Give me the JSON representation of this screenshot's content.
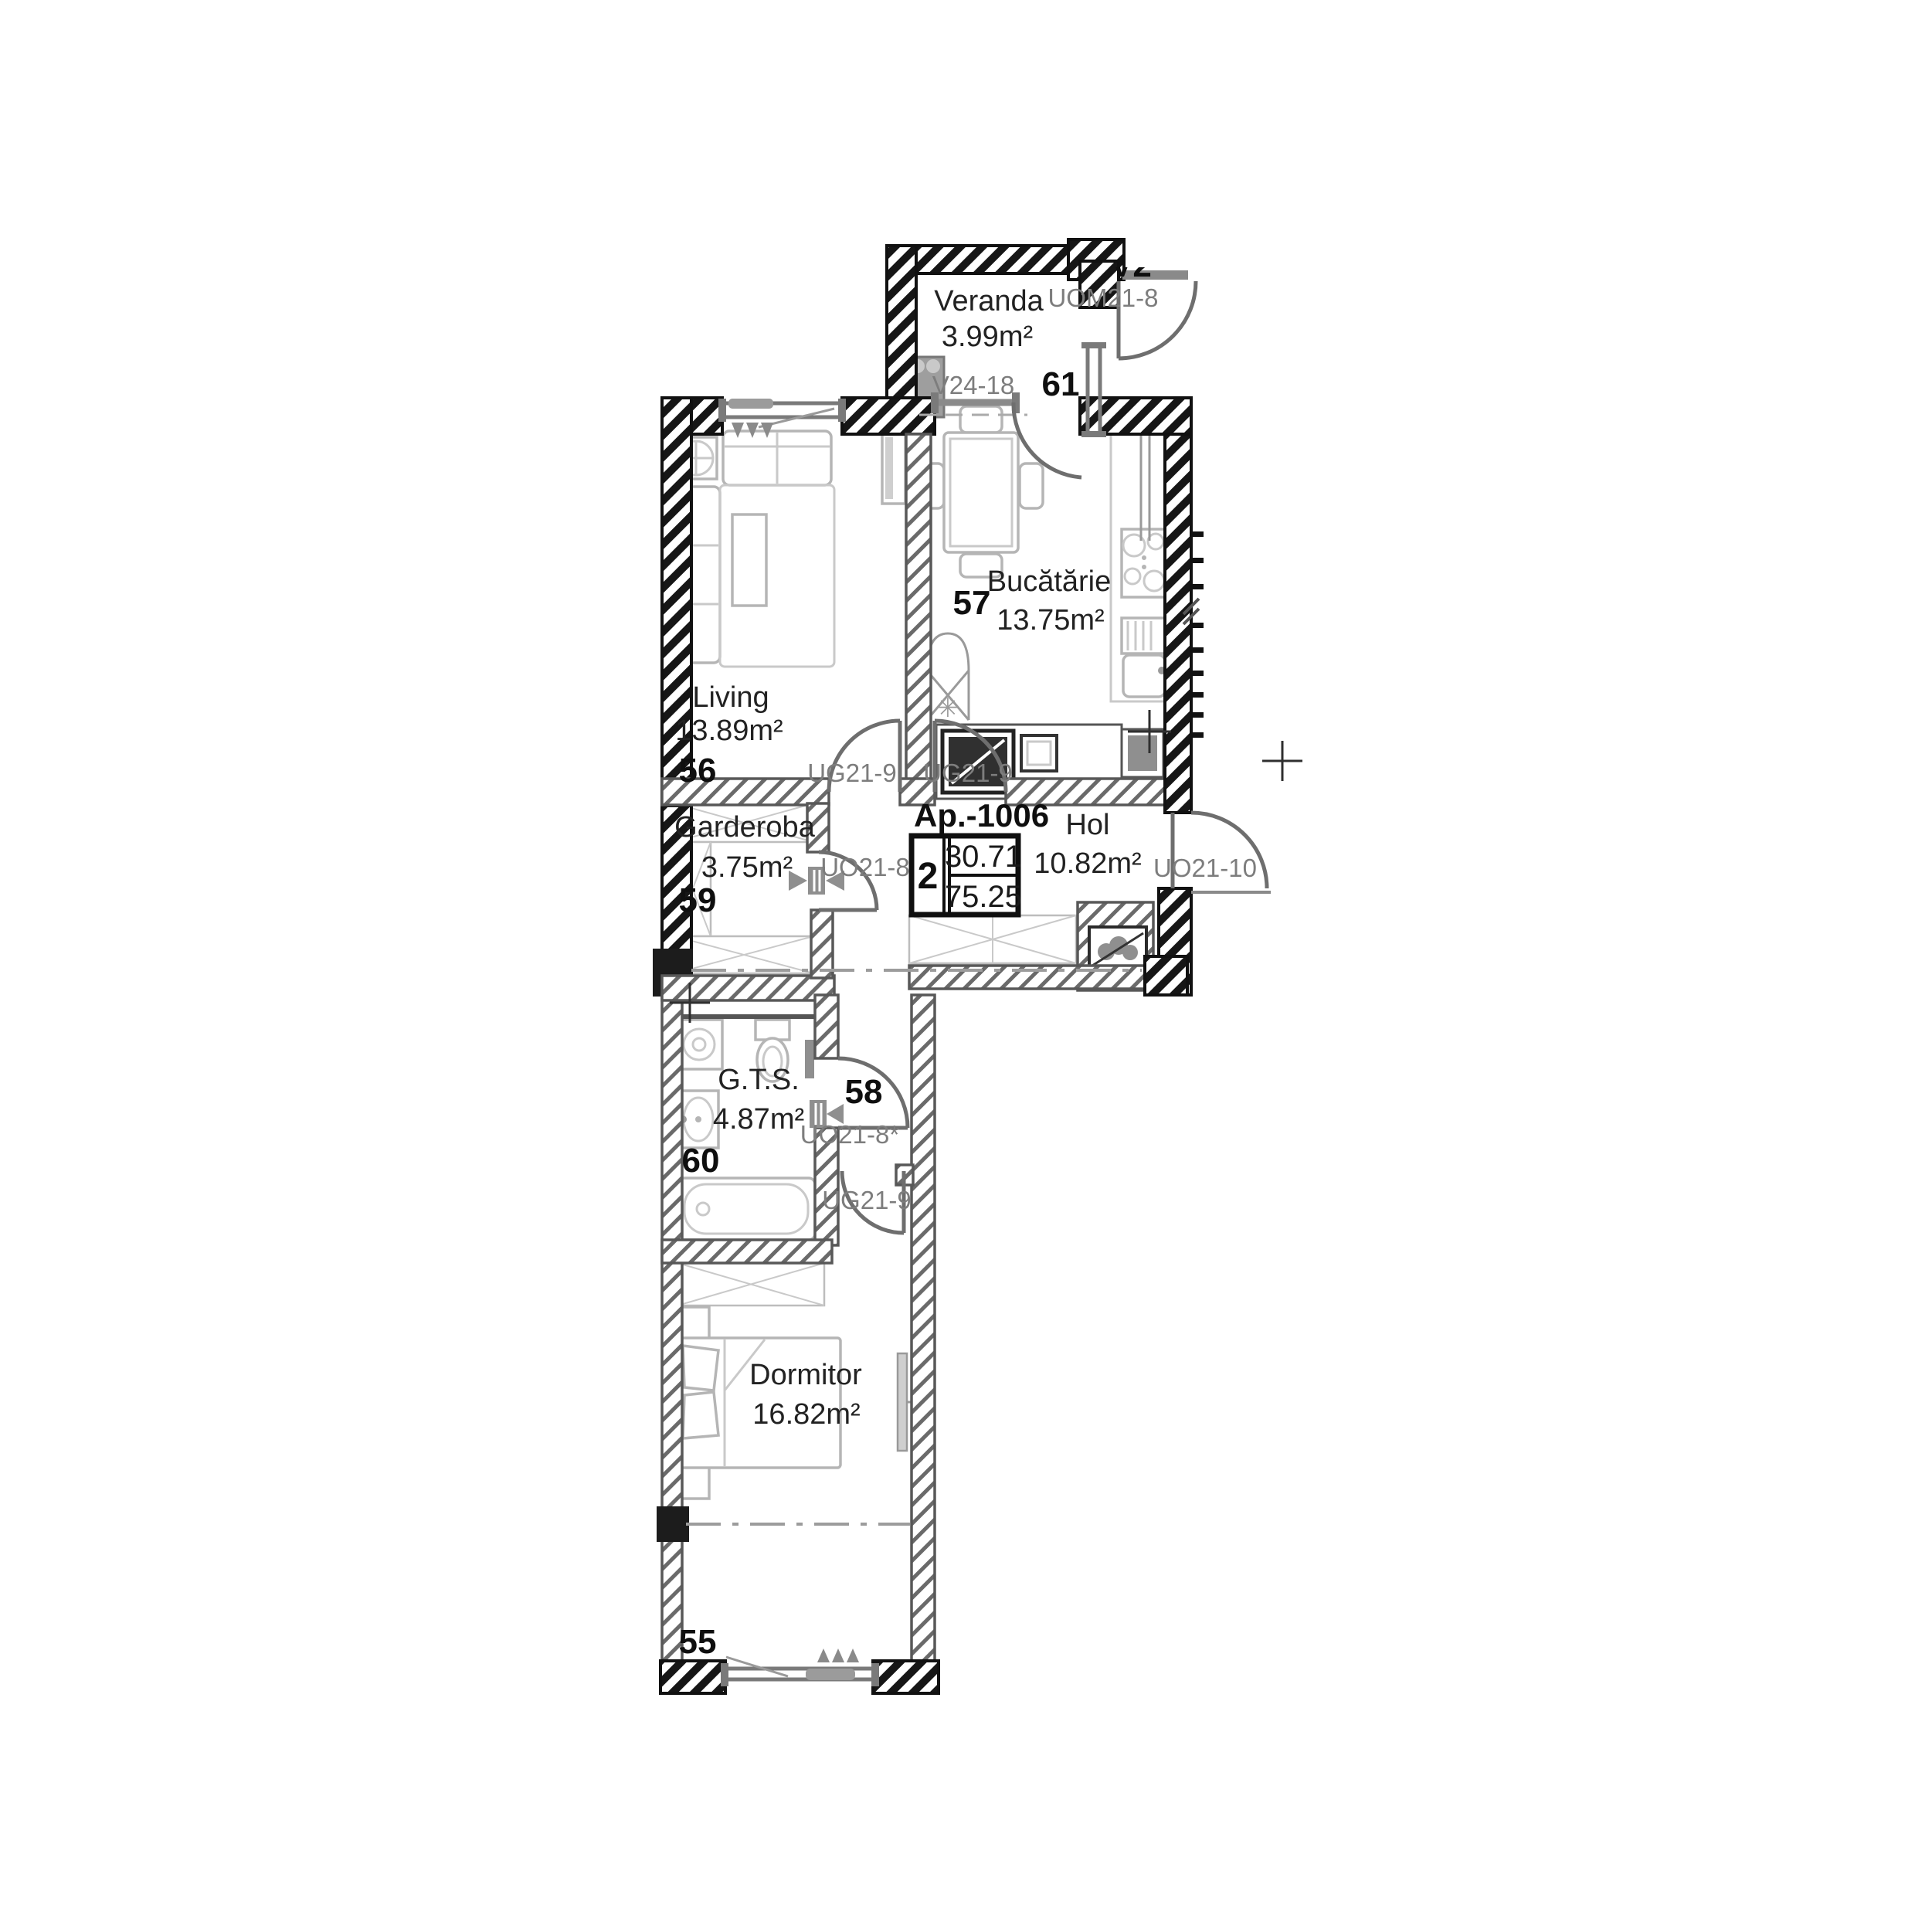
{
  "plan": {
    "apartment": {
      "title": "Ap.-1006",
      "rooms_badge": "2",
      "area_useful": "30.71",
      "area_total": "75.25"
    },
    "rooms": {
      "veranda": {
        "name": "Veranda",
        "area": "3.99m²",
        "number": "61"
      },
      "living": {
        "name": "Living",
        "area": "13.89m²",
        "number": "56"
      },
      "bucatarie": {
        "name": "Bucătărie",
        "area": "13.75m²",
        "number": "57"
      },
      "hol": {
        "name": "Hol",
        "area": "10.82m²",
        "number": "58"
      },
      "garderoba": {
        "name": "Garderoba",
        "area": "3.75m²",
        "number": "59"
      },
      "gts": {
        "name": "G.T.S.",
        "area": "4.87m²",
        "number": "60"
      },
      "dormitor": {
        "name": "Dormitor",
        "area": "16.82m²",
        "number": "55"
      }
    },
    "openings": {
      "uom21_8": "UOM21-8",
      "v24_18": "V24-18",
      "ug21_9_living": "UG21-9",
      "ug21_9_kitchen": "UG21-9",
      "uo21_8_garderoba": "UO21-8",
      "uo21_10_entrance": "UO21-10",
      "uo21_8_gts": "UO21-8*",
      "ug21_9_dormitor": "UG21-9"
    },
    "clipped_label": "V2",
    "colors": {
      "wall": "#111111",
      "partition": "#585858",
      "furniture": "#b5b5b5",
      "door": "#6e6e6e",
      "code_text": "#7d7d7d",
      "text": "#222222",
      "background": "#ffffff"
    }
  }
}
